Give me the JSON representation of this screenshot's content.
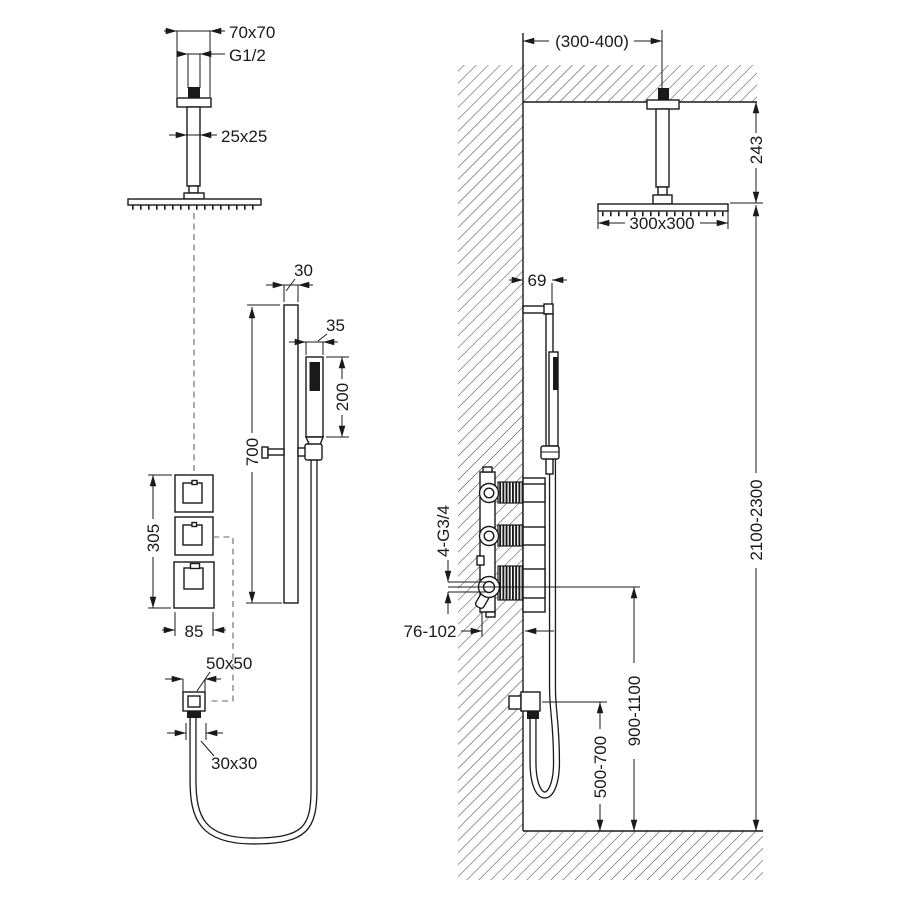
{
  "drawing": {
    "background": "#ffffff",
    "line_color": "#1a1a1a",
    "left": {
      "flange": "70x70",
      "thread": "G1/2",
      "arm": "25x25",
      "bar_width": "30",
      "hand_width": "35",
      "hand_length": "200",
      "bar_length": "700",
      "trim_height": "305",
      "trim_width": "85",
      "outlet_size": "50x50",
      "connector_size": "30x30"
    },
    "right": {
      "arm_offset": "(300-400)",
      "ceiling_drop": "243",
      "head_size": "300x300",
      "bar_depth": "69",
      "ports": "4-G3/4",
      "recess_depth": "76-102",
      "head_height": "2100-2300",
      "valve_height": "900-1100",
      "outlet_height": "500-700"
    }
  }
}
